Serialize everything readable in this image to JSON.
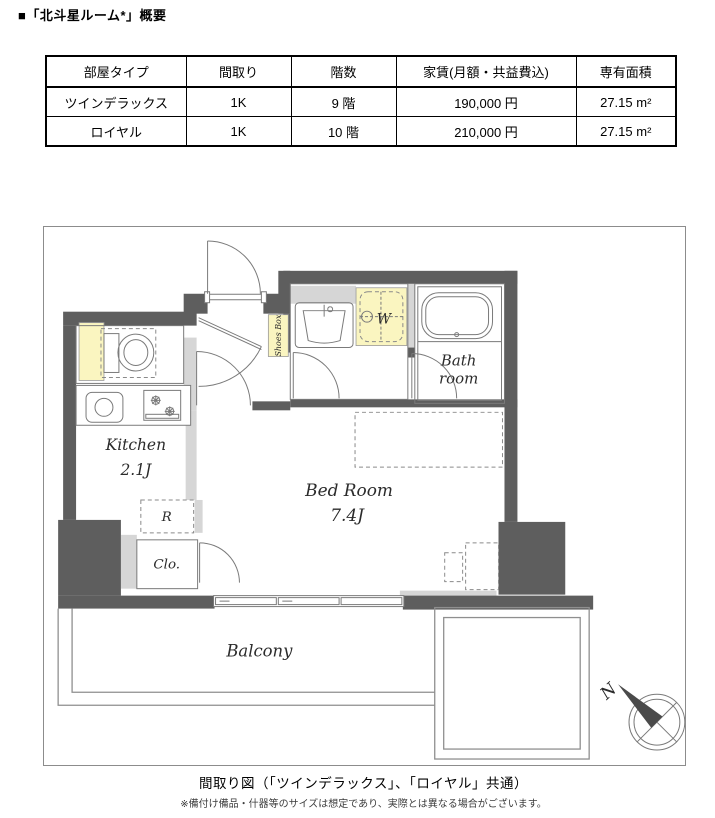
{
  "title": "■「北斗星ルーム*」概要",
  "table": {
    "headers": [
      "部屋タイプ",
      "間取り",
      "階数",
      "家賃(月額・共益費込)",
      "専有面積"
    ],
    "rows": [
      {
        "type": "ツインデラックス",
        "layout": "1K",
        "floor": "9 階",
        "rent": "190,000 円",
        "area": "27.15 m²"
      },
      {
        "type": "ロイヤル",
        "layout": "1K",
        "floor": "10 階",
        "rent": "210,000 円",
        "area": "27.15 m²"
      }
    ]
  },
  "floorplan": {
    "labels": {
      "kitchen": "Kitchen",
      "kitchen_size": "2.1J",
      "bedroom": "Bed Room",
      "bedroom_size": "7.4J",
      "bath_line1": "Bath",
      "bath_line2": "room",
      "balcony": "Balcony",
      "closet": "Clo.",
      "refrigerator": "R",
      "washer": "W",
      "shoes_box": "Shoes Box",
      "compass_north": "N"
    },
    "colors": {
      "wall": "#5e5e5e",
      "light_wall": "#d6d6d6",
      "highlight_yellow": "#faf5c0",
      "line": "#7a7a7a"
    }
  },
  "caption": "間取り図（「ツインデラックス」、「ロイヤル」共通）",
  "footnote": "※備付け備品・什器等のサイズは想定であり、実際とは異なる場合がございます。"
}
